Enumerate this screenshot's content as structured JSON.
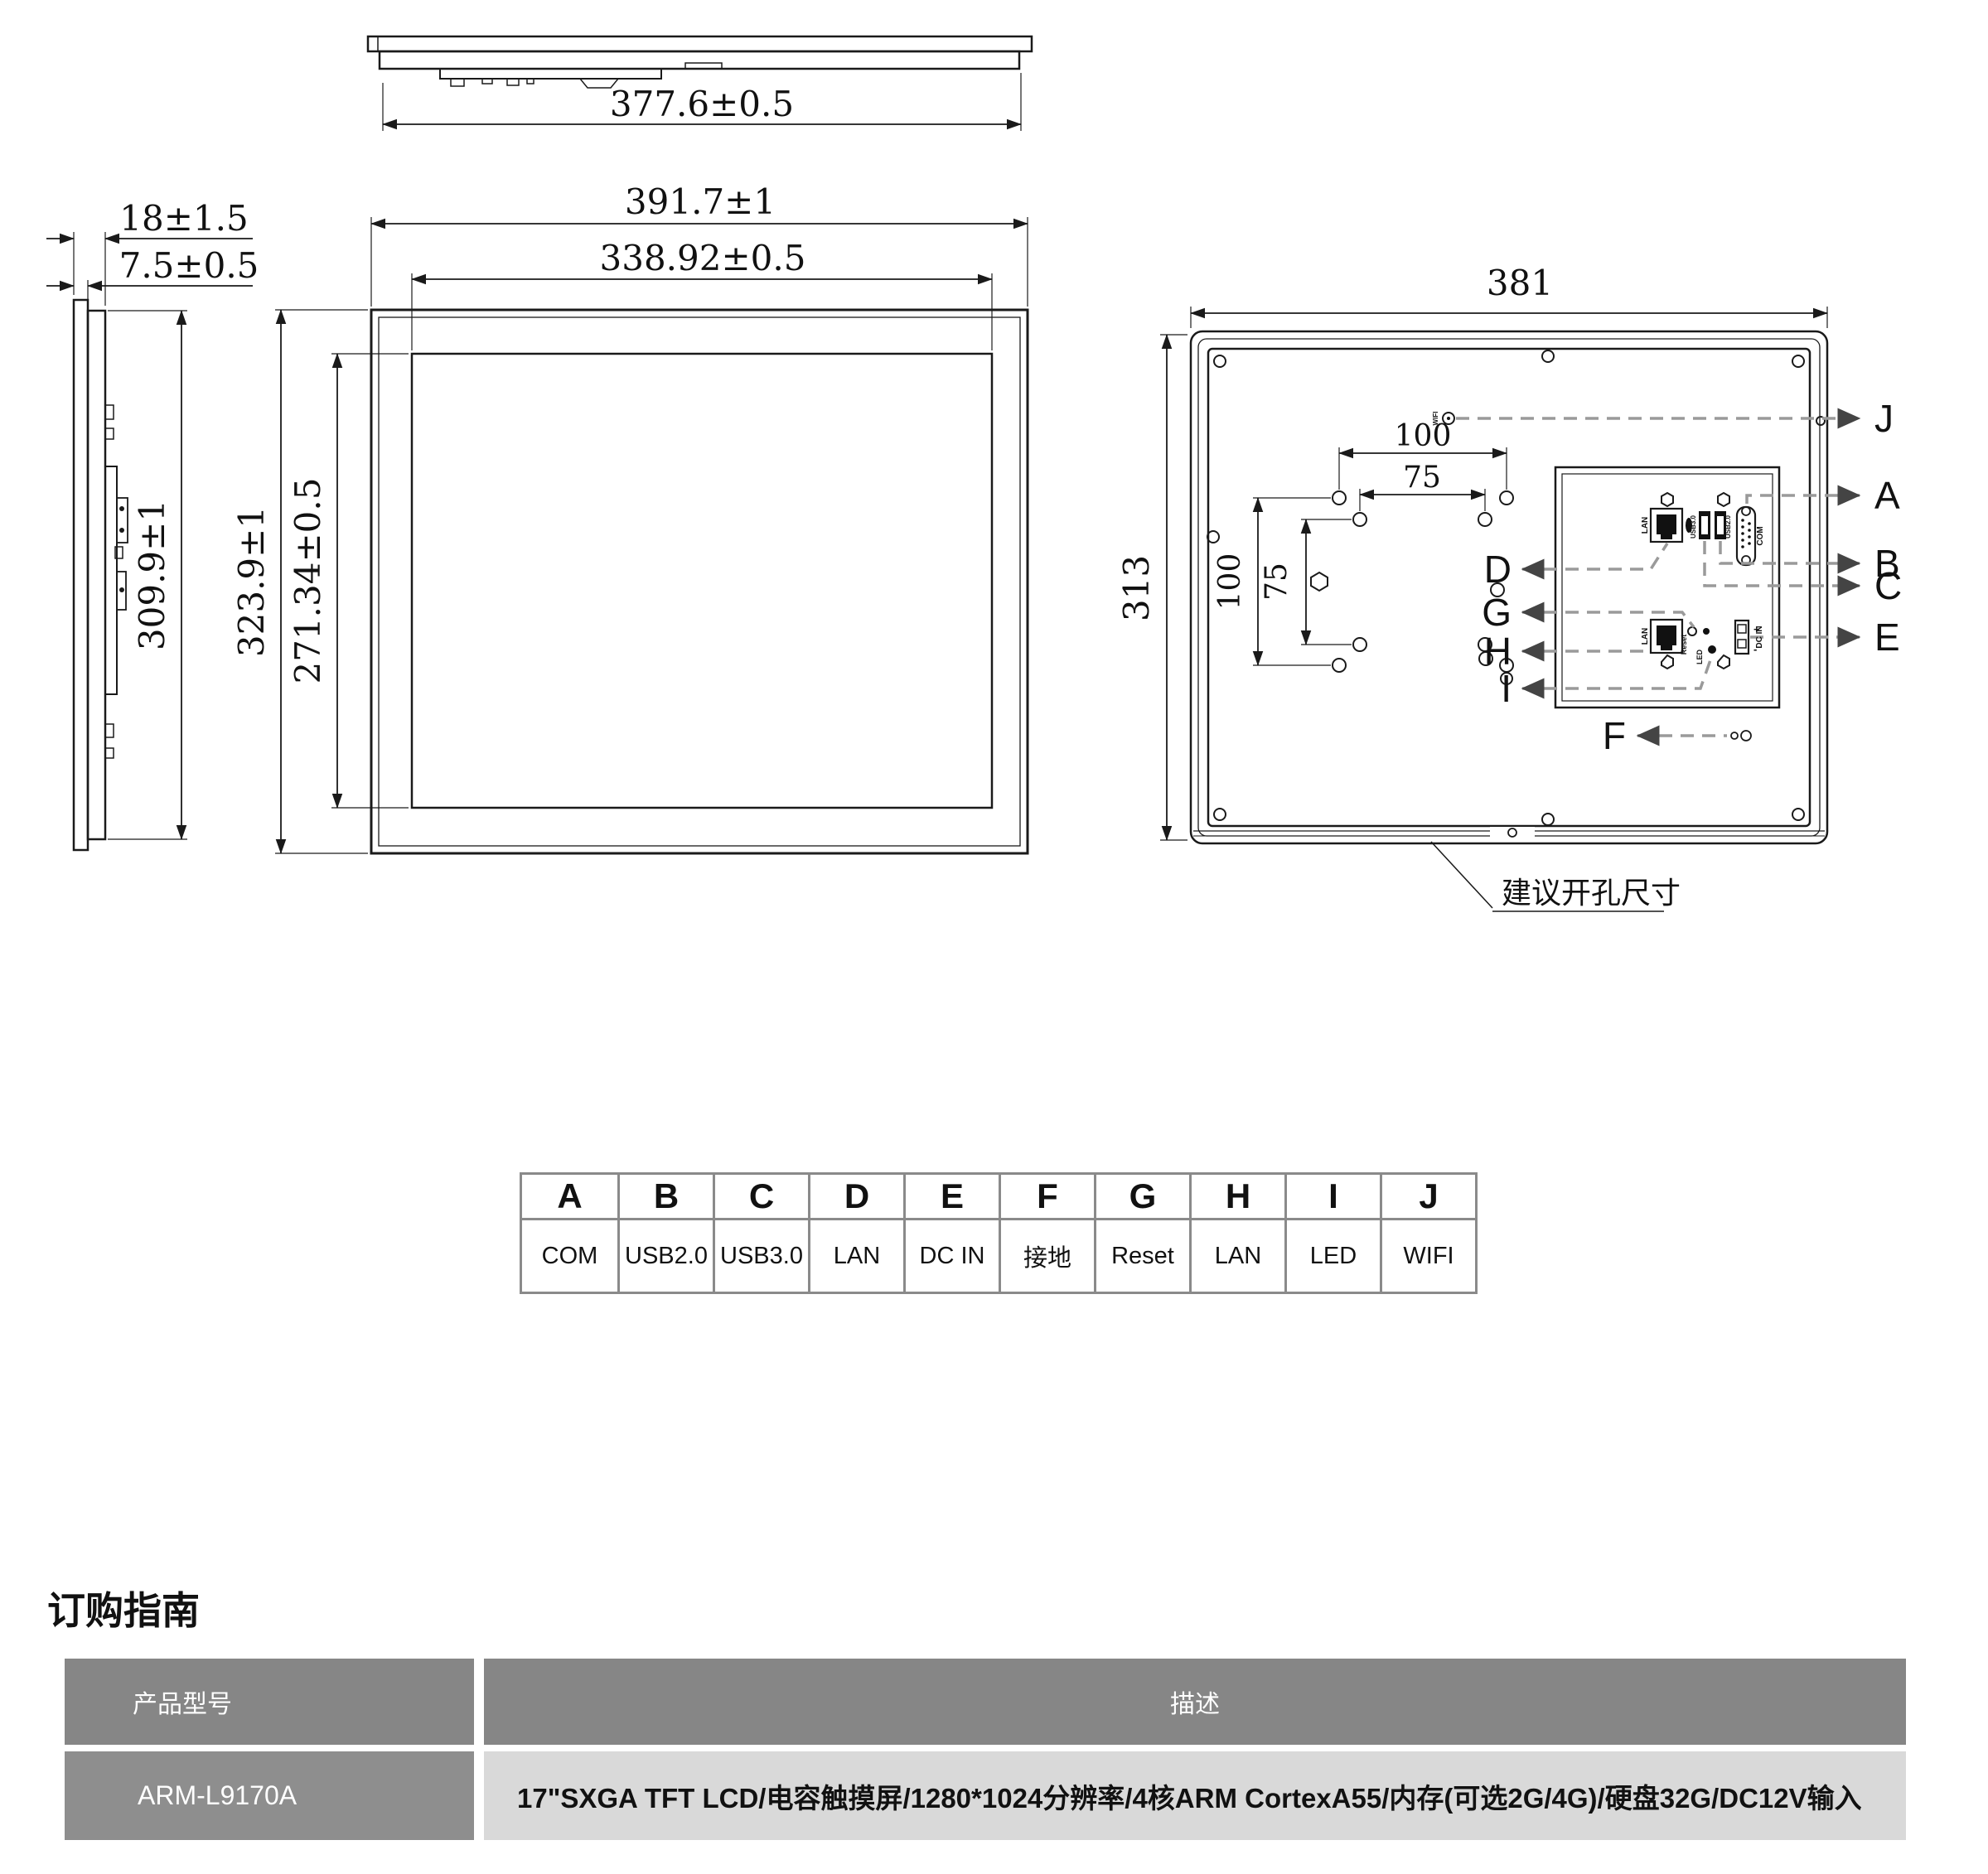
{
  "drawing": {
    "top_view": {
      "width": "377.6±0.5"
    },
    "side_view": {
      "thickness": "18±1.5",
      "bezel": "7.5±0.5",
      "height": "309.9±1"
    },
    "front_view": {
      "width": "391.7±1",
      "screen_width": "338.92±0.5",
      "height": "323.9±1",
      "screen_height": "271.34±0.5"
    },
    "rear_view": {
      "width": "381",
      "height": "313",
      "vesa_h100": "100",
      "vesa_h75": "75",
      "vesa_v100": "100",
      "vesa_v75": "75",
      "cutout_note": "建议开孔尺寸",
      "ports": {
        "lan": "LAN",
        "lan2": "LAN",
        "usb30": "USB3.0",
        "usb20": "USB2.0",
        "com": "COM",
        "reset": "Reset",
        "led": "LED",
        "dcin": "DC IN",
        "wifi": "WIFI",
        "plus": "+",
        "minus": "-"
      },
      "callouts": {
        "a": "A",
        "b": "B",
        "c": "C",
        "d": "D",
        "e": "E",
        "f": "F",
        "g": "G",
        "h": "H",
        "i": "I",
        "j": "J"
      }
    }
  },
  "legend": {
    "items": [
      {
        "key": "A",
        "value": "COM"
      },
      {
        "key": "B",
        "value": "USB2.0"
      },
      {
        "key": "C",
        "value": "USB3.0"
      },
      {
        "key": "D",
        "value": "LAN"
      },
      {
        "key": "E",
        "value": "DC IN"
      },
      {
        "key": "F",
        "value": "接地"
      },
      {
        "key": "G",
        "value": "Reset"
      },
      {
        "key": "H",
        "value": "LAN"
      },
      {
        "key": "I",
        "value": "LED"
      },
      {
        "key": "J",
        "value": "WIFI"
      }
    ]
  },
  "ordering": {
    "heading": "订购指南",
    "col_model": "产品型号",
    "col_desc": "描述",
    "model": "ARM-L9170A",
    "desc": "17\"SXGA TFT LCD/电容触摸屏/1280*1024分辨率/4核ARM CortexA55/内存(可选2G/4G)/硬盘32G/DC12V输入"
  },
  "colors": {
    "line": "#1a1a1a",
    "dash": "#9a9a9a",
    "table_border": "#8a8a8a",
    "gray_dark": "#868686",
    "gray_light": "#d9d9d9"
  }
}
